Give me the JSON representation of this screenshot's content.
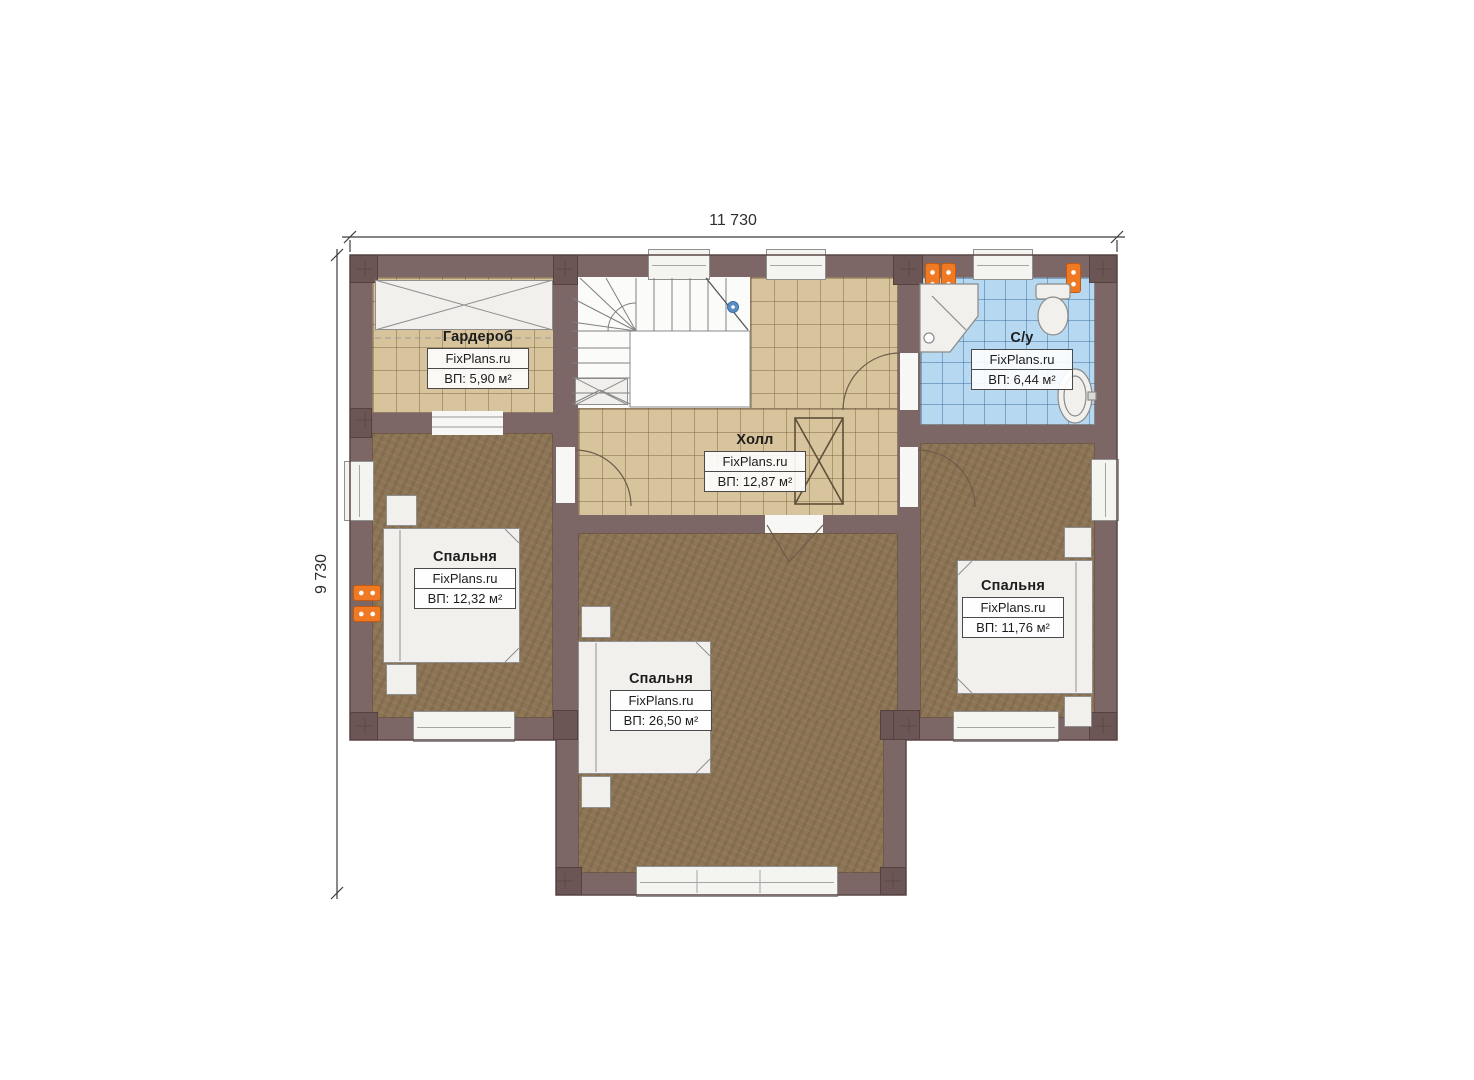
{
  "title": "План этажа",
  "brand": "FixPlans.ru",
  "dimensions": {
    "top": "11 730",
    "left": "9 730"
  },
  "rooms": [
    {
      "id": "wardrobe",
      "name": "Гардероб",
      "area": "ВП: 5,90 м²"
    },
    {
      "id": "hall",
      "name": "Холл",
      "area": "ВП: 12,87 м²"
    },
    {
      "id": "bathroom",
      "name": "С/у",
      "area": "ВП: 6,44 м²"
    },
    {
      "id": "bedroom-left",
      "name": "Спальня",
      "area": "ВП: 12,32 м²"
    },
    {
      "id": "bedroom-center",
      "name": "Спальня",
      "area": "ВП: 26,50 м²"
    },
    {
      "id": "bedroom-right",
      "name": "Спальня",
      "area": "ВП: 11,76 м²"
    }
  ],
  "colors": {
    "wall": "#7d6666",
    "pier": "#6c5555",
    "tile": "#d8c49c",
    "bath": "#b6d8f1",
    "wood": "#8c7454",
    "fixture": "#f1f0ed",
    "radiator": "#ef7a23",
    "line": "#6b5b4b",
    "dim": "#2e2e2e"
  }
}
